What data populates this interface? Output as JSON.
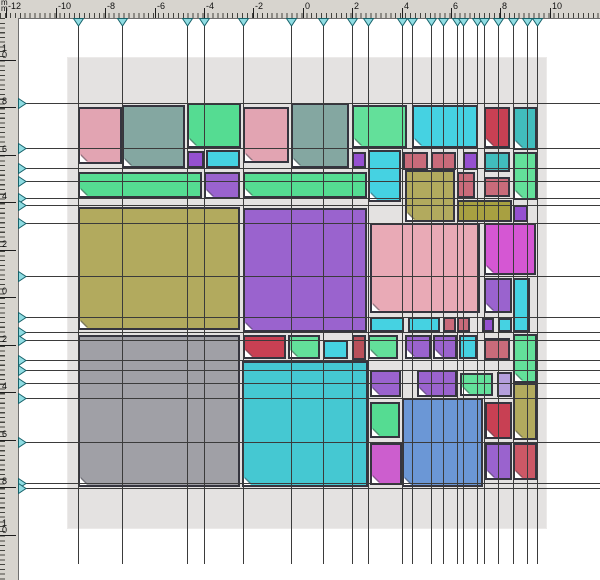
{
  "window": {
    "unit_label": "mm"
  },
  "palette": {
    "rose": "#e2a4b2",
    "pinkbig": "#e9aab6",
    "teal": "#84a7a1",
    "green": "#55dc92",
    "mint": "#63e09a",
    "purple": "#9a63ce",
    "purplex": "#9550d0",
    "cyanx": "#45d2e2",
    "teal2": "#41bdbd",
    "redx": "#c84053",
    "olive": "#b2aa5e",
    "olived": "#a8a041",
    "magenta": "#d557d3",
    "magenta2": "#cc5ece",
    "gray": "#a0a0a6",
    "cyanbig": "#45c8d2",
    "blue": "#6b97d6",
    "rosesolid": "#c96b7a",
    "darkred": "#b8505a",
    "lavender": "#b49fdc",
    "reddr": "#cc5866",
    "guide_line": "#3b3b3b",
    "marker_fill": "#8fdce2",
    "marker_stroke": "#17626a",
    "page_bg": "#e4e2e1"
  },
  "ruler_top": {
    "labels": [
      {
        "t": "-12",
        "x": 6
      },
      {
        "t": "-10",
        "x": 56
      },
      {
        "t": "-8",
        "x": 105
      },
      {
        "t": "-6",
        "x": 155
      },
      {
        "t": "-4",
        "x": 204
      },
      {
        "t": "-2",
        "x": 253
      },
      {
        "t": "0",
        "x": 303
      },
      {
        "t": "2",
        "x": 352
      },
      {
        "t": "4",
        "x": 402
      },
      {
        "t": "6",
        "x": 451
      },
      {
        "t": "8",
        "x": 500
      },
      {
        "t": "10",
        "x": 550
      }
    ]
  },
  "ruler_left": {
    "labels": [
      {
        "t": "10",
        "y": 60
      },
      {
        "t": "8",
        "y": 107
      },
      {
        "t": "6",
        "y": 155
      },
      {
        "t": "4",
        "y": 202
      },
      {
        "t": "2",
        "y": 250
      },
      {
        "t": "0",
        "y": 297
      },
      {
        "t": "2",
        "y": 345
      },
      {
        "t": "4",
        "y": 392
      },
      {
        "t": "6",
        "y": 440
      },
      {
        "t": "8",
        "y": 487
      },
      {
        "t": "10",
        "y": 535
      }
    ]
  },
  "guides": {
    "x": [
      78,
      122,
      187,
      204,
      243,
      291,
      323,
      352,
      368,
      402,
      412,
      431,
      443,
      457,
      463,
      477,
      484,
      498,
      513,
      527,
      537
    ],
    "y": [
      103,
      148,
      168,
      181,
      198,
      205,
      223,
      276,
      317,
      332,
      340,
      360,
      370,
      383,
      398,
      442,
      483,
      488
    ]
  },
  "page": {
    "x": 68,
    "y": 58,
    "w": 478,
    "h": 470
  },
  "shapes": [
    [
      78,
      107,
      44,
      57,
      "rose",
      "diagx"
    ],
    [
      122,
      105,
      63,
      63,
      "teal",
      "vstripe"
    ],
    [
      187,
      103,
      54,
      45,
      "green",
      "vstripe"
    ],
    [
      187,
      151,
      17,
      17,
      "purplex",
      "grid"
    ],
    [
      206,
      150,
      34,
      18,
      "cyanx",
      "grid"
    ],
    [
      243,
      107,
      46,
      56,
      "rose",
      "diagx"
    ],
    [
      291,
      103,
      58,
      65,
      "teal",
      "vstripe"
    ],
    [
      352,
      105,
      55,
      43,
      "mint",
      "check"
    ],
    [
      412,
      105,
      66,
      43,
      "cyanx",
      "diagx"
    ],
    [
      484,
      107,
      26,
      41,
      "redx",
      "grid"
    ],
    [
      513,
      107,
      24,
      43,
      "teal2",
      "vstripe"
    ],
    [
      352,
      152,
      14,
      16,
      "purplex",
      "grid"
    ],
    [
      368,
      150,
      33,
      52,
      "cyanx",
      "diagx"
    ],
    [
      403,
      152,
      25,
      18,
      "rosesolid",
      "diag"
    ],
    [
      431,
      152,
      25,
      18,
      "rosesolid",
      "diag"
    ],
    [
      463,
      152,
      15,
      18,
      "purplex",
      "grid"
    ],
    [
      484,
      152,
      26,
      20,
      "teal2",
      "vstripe"
    ],
    [
      513,
      152,
      24,
      48,
      "mint",
      "check"
    ],
    [
      78,
      172,
      124,
      26,
      "green",
      "vstripe"
    ],
    [
      204,
      172,
      36,
      27,
      "purple",
      "diagd"
    ],
    [
      243,
      172,
      124,
      26,
      "green",
      "vstripe"
    ],
    [
      405,
      170,
      50,
      52,
      "olive",
      "check"
    ],
    [
      457,
      172,
      18,
      26,
      "rosesolid",
      "diag"
    ],
    [
      484,
      177,
      26,
      20,
      "rosesolid",
      "diag"
    ],
    [
      457,
      200,
      55,
      22,
      "olived",
      "diagd"
    ],
    [
      513,
      205,
      15,
      17,
      "purplex",
      "grid"
    ],
    [
      78,
      207,
      162,
      123,
      "olive",
      "check"
    ],
    [
      243,
      208,
      124,
      124,
      "purple",
      "diagd"
    ],
    [
      370,
      223,
      110,
      90,
      "pinkbig",
      "diagx"
    ],
    [
      484,
      223,
      52,
      52,
      "magenta",
      "diag"
    ],
    [
      484,
      278,
      28,
      35,
      "purple",
      "diagd"
    ],
    [
      513,
      278,
      17,
      54,
      "cyanx",
      "grid"
    ],
    [
      370,
      317,
      34,
      15,
      "cyanx",
      "grid"
    ],
    [
      408,
      317,
      32,
      15,
      "cyanx",
      "grid"
    ],
    [
      443,
      317,
      13,
      15,
      "rosesolid",
      "diag"
    ],
    [
      457,
      317,
      13,
      15,
      "rosesolid",
      "diag"
    ],
    [
      482,
      318,
      12,
      14,
      "purplex",
      "grid"
    ],
    [
      498,
      318,
      14,
      14,
      "cyanx",
      "grid"
    ],
    [
      243,
      335,
      43,
      24,
      "redx",
      "grid"
    ],
    [
      288,
      335,
      32,
      24,
      "mint",
      "grid"
    ],
    [
      323,
      340,
      25,
      19,
      "cyanx",
      "vstripe"
    ],
    [
      352,
      335,
      14,
      25,
      "darkred",
      "vstripe"
    ],
    [
      368,
      335,
      30,
      24,
      "mint",
      "grid"
    ],
    [
      405,
      335,
      26,
      24,
      "purple",
      "diagd"
    ],
    [
      433,
      335,
      24,
      24,
      "purple",
      "diagd"
    ],
    [
      459,
      335,
      18,
      24,
      "cyanx",
      "grid"
    ],
    [
      484,
      338,
      26,
      22,
      "rosesolid",
      "diag"
    ],
    [
      513,
      334,
      24,
      49,
      "mint",
      "check"
    ],
    [
      78,
      335,
      162,
      152,
      "gray",
      "diagx"
    ],
    [
      242,
      361,
      126,
      126,
      "cyanbig",
      "check"
    ],
    [
      370,
      370,
      31,
      27,
      "purple",
      "diagd"
    ],
    [
      417,
      370,
      40,
      27,
      "purple",
      "diagd"
    ],
    [
      460,
      373,
      33,
      23,
      "mint",
      "grid"
    ],
    [
      497,
      372,
      15,
      25,
      "lavender",
      "grid"
    ],
    [
      513,
      383,
      24,
      57,
      "olive",
      "check"
    ],
    [
      370,
      402,
      30,
      36,
      "green",
      "vstripe"
    ],
    [
      402,
      398,
      81,
      89,
      "blue",
      "diagx"
    ],
    [
      485,
      402,
      27,
      37,
      "redx",
      "grid"
    ],
    [
      370,
      443,
      32,
      42,
      "magenta2",
      "diag"
    ],
    [
      485,
      443,
      27,
      37,
      "purple",
      "diagd"
    ],
    [
      513,
      443,
      24,
      37,
      "reddr",
      "diag"
    ]
  ]
}
